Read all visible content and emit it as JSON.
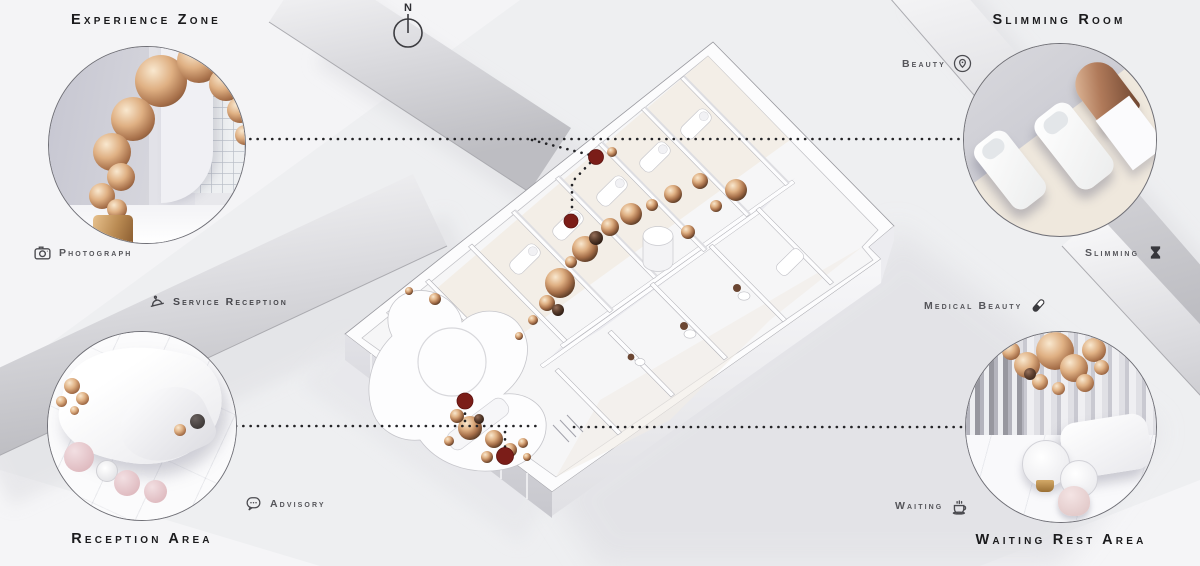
{
  "colors": {
    "background": "#eeeff1",
    "copper": "#c08a5f",
    "marker_red": "#7b1d18",
    "title_text": "#1b1b1d",
    "label_text": "#55555a",
    "band_gray": "#c6c6cb"
  },
  "compass": {
    "north_label": "N"
  },
  "callouts": {
    "experience_zone": {
      "title": "Experience Zone"
    },
    "slimming_room": {
      "title": "Slimming Room"
    },
    "reception_area": {
      "title": "Reception Area"
    },
    "waiting_rest_area": {
      "title": "Waiting Rest Area"
    }
  },
  "labels": {
    "beauty": {
      "text": "Beauty",
      "icon": "location-pin-icon"
    },
    "photograph": {
      "text": "Photograph",
      "icon": "camera-icon"
    },
    "service_reception": {
      "text": "Service Reception",
      "icon": "bell-icon"
    },
    "slimming": {
      "text": "Slimming",
      "icon": "hourglass-icon"
    },
    "medical_beauty": {
      "text": "Medical Beauty",
      "icon": "capsule-icon"
    },
    "advisory": {
      "text": "Advisory",
      "icon": "speech-bubble-icon"
    },
    "waiting": {
      "text": "Waiting",
      "icon": "coffee-cup-icon"
    }
  }
}
